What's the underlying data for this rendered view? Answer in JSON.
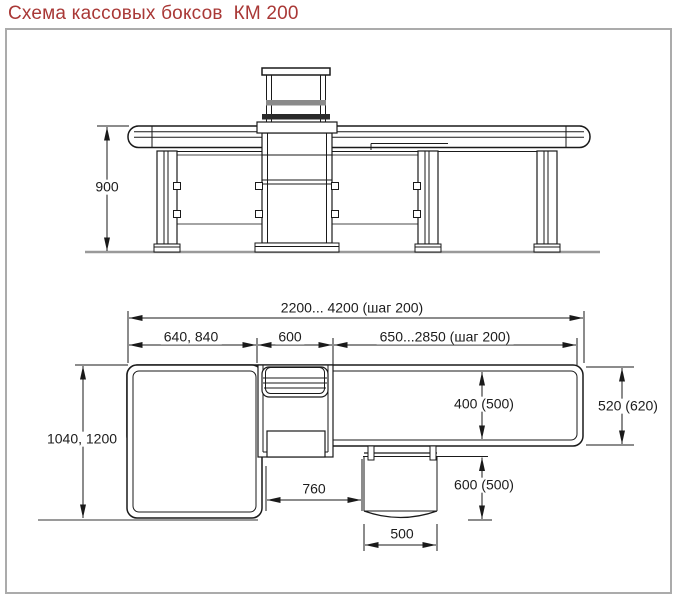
{
  "title": "Схема кассовых боксов  КМ 200",
  "colors": {
    "title": "#a93836",
    "line": "#1a1a1a",
    "muted": "#9a9a9a"
  },
  "elevation_view": {
    "description": "front elevation of checkout counter",
    "dims": {
      "height": "900"
    }
  },
  "plan_view": {
    "description": "top plan of checkout counter",
    "dims": {
      "overall_length": "2200... 4200 (шаг 200)",
      "left_table_length": "640, 840",
      "cash_module_length": "600",
      "belt_length": "650...2850 (шаг 200)",
      "overall_depth": "1040, 1200",
      "belt_width": "400 (500)",
      "end_depth": "520 (620)",
      "operator_clearance": "760",
      "seat_recess_depth": "600 (500)",
      "seat_width": "500"
    }
  }
}
